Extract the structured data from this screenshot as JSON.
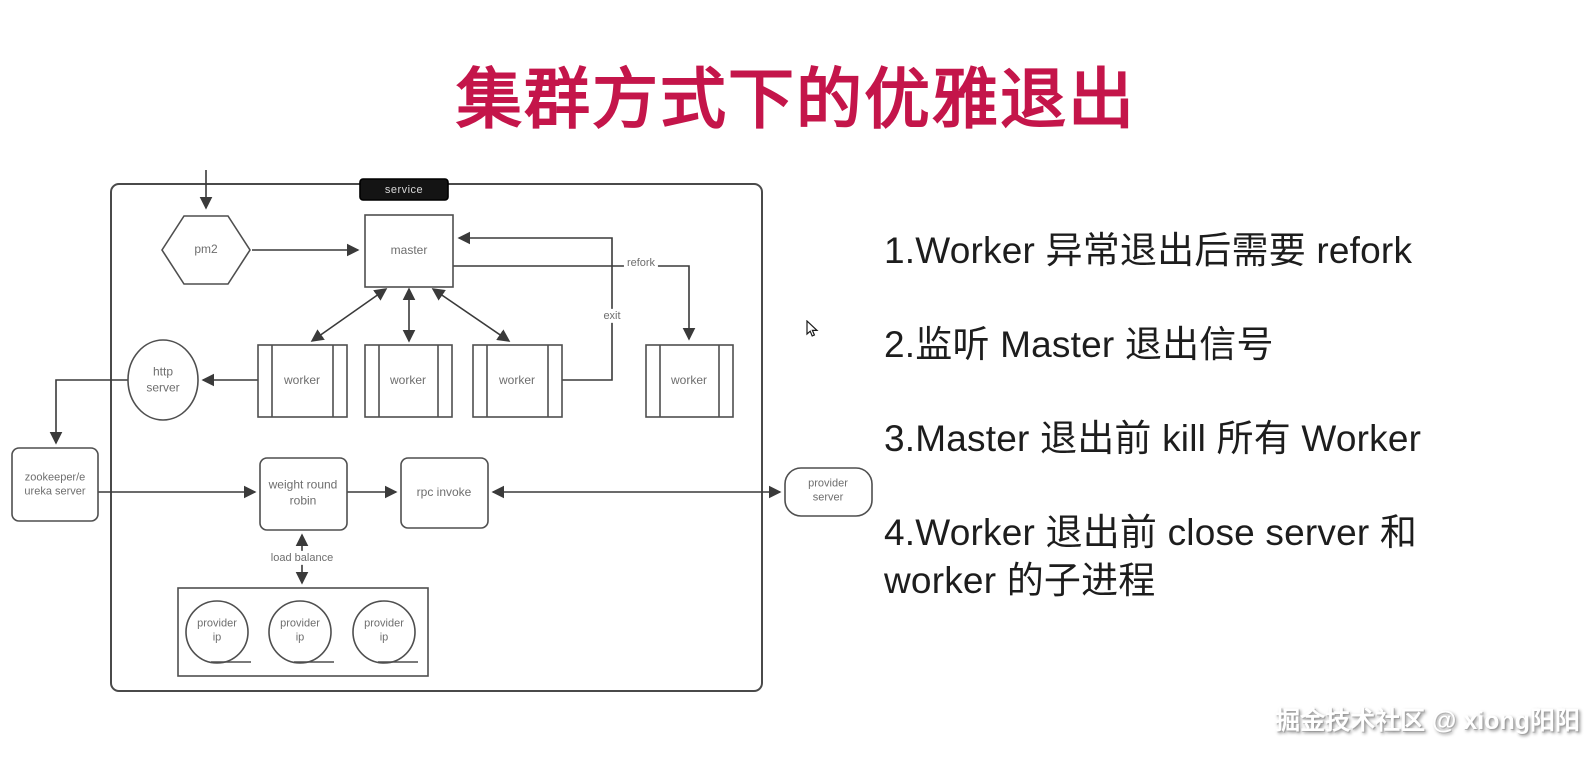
{
  "title": "集群方式下的优雅退出",
  "diagram": {
    "container_label": "service",
    "nodes": {
      "pm2": "pm2",
      "master": "master",
      "worker": "worker",
      "http_server": [
        "http",
        "server"
      ],
      "zookeeper": [
        "zookeeper/e",
        "ureka server"
      ],
      "weight_round_robin": [
        "weight round",
        "robin"
      ],
      "rpc_invoke": "rpc invoke",
      "provider_server": [
        "provider",
        "server"
      ],
      "provider_ip": [
        "provider",
        "ip"
      ]
    },
    "edge_labels": {
      "refork": "refork",
      "exit": "exit",
      "load_balance": "load balance"
    }
  },
  "notes": {
    "items": [
      "1.Worker 异常退出后需要 refork",
      "2.监听 Master 退出信号",
      "3.Master 退出前 kill 所有 Worker",
      "4.Worker 退出前 close server 和\nworker 的子进程"
    ]
  },
  "watermark": "掘金技术社区 @ xiong阳阳",
  "colors": {
    "title": "#C4154A",
    "diagram_line": "#3a3a3a",
    "note_text": "#1d1d1d",
    "service_pill_bg": "#141414"
  }
}
